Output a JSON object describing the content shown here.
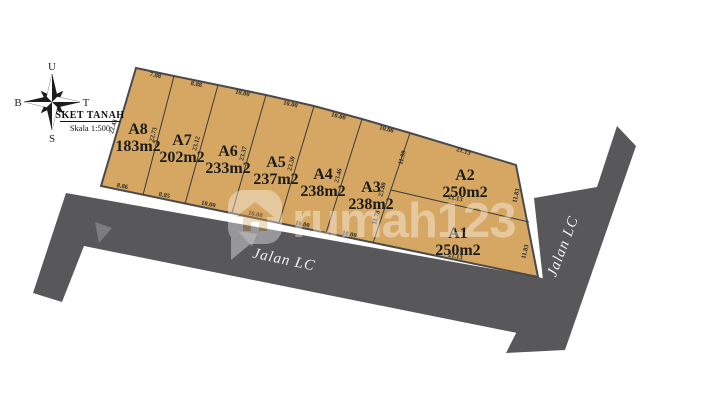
{
  "meta": {
    "title": "SKET TANAH",
    "scale": "Skala 1:500"
  },
  "compass": {
    "north": "U",
    "east": "T",
    "south": "S",
    "west": "B"
  },
  "watermark": {
    "brand": "rumah123"
  },
  "roads": {
    "bottom_label": "Jalan LC",
    "right_label": "Jalan LC"
  },
  "plots": [
    {
      "id": "A8",
      "area": "183m2"
    },
    {
      "id": "A7",
      "area": "202m2"
    },
    {
      "id": "A6",
      "area": "233m2"
    },
    {
      "id": "A5",
      "area": "237m2"
    },
    {
      "id": "A4",
      "area": "238m2"
    },
    {
      "id": "A3",
      "area": "238m2"
    },
    {
      "id": "A2",
      "area": "250m2"
    },
    {
      "id": "A1",
      "area": "250m2"
    }
  ],
  "dims": {
    "a8_top": "7.88",
    "a7_top": "8.88",
    "a6_top": "10.00",
    "a5_top": "10.00",
    "a4_top": "10.00",
    "a3_top": "10.00",
    "a2_top": "21.13",
    "a8_bottom": "8.86",
    "a7_bottom": "8.85",
    "a6_bottom": "10.00",
    "a5_bottom": "10.00",
    "a4_bottom": "10.00",
    "a3_bottom": "10.00",
    "a1_bottom": "21.13",
    "a8_left": "22.43",
    "div_a8_a7": "22.73",
    "div_a7_a6": "23.12",
    "div_a6_a5": "23.37",
    "div_a5_a4": "23.50",
    "div_a4_a3": "23.46",
    "div_a3_a2": "23.80",
    "a2_left": "11.99",
    "a1_left": "11.78",
    "div_a2_a1": "21.13",
    "a2_right": "11.83",
    "a1_right": "11.83"
  },
  "colors": {
    "plot": "#d5a763",
    "road": "#58585a",
    "road_accent": "#7d7d81",
    "outline": "#4a4a4c"
  }
}
